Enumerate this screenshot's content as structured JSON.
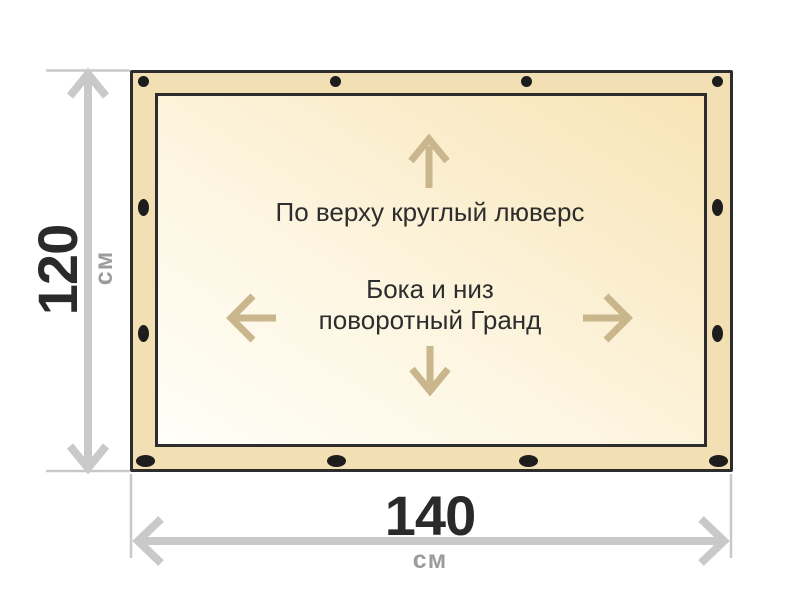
{
  "canvas": {
    "background": "#ffffff"
  },
  "banner": {
    "fabric_color": "#f3dfb4",
    "outline_color": "#2d2d2d",
    "inner_gradient_start": "#fffef8",
    "inner_gradient_end": "#f8e4b6",
    "grommet_color": "#1d1d1d",
    "grommets": {
      "top_count": 4,
      "bottom_count": 4,
      "left_count": 2,
      "right_count": 2
    }
  },
  "notes": {
    "top": "По верху круглый люверс",
    "center_line1": "Бока и низ",
    "center_line2": "поворотный Гранд",
    "text_color": "#2d2d2d",
    "arrow_color": "#c9b68c"
  },
  "dimensions": {
    "height": {
      "value": "120",
      "unit": "см"
    },
    "width": {
      "value": "140",
      "unit": "см"
    },
    "line_color": "#c9c9c9",
    "value_color": "#2a2a2a",
    "unit_color": "#9c9c9c"
  }
}
